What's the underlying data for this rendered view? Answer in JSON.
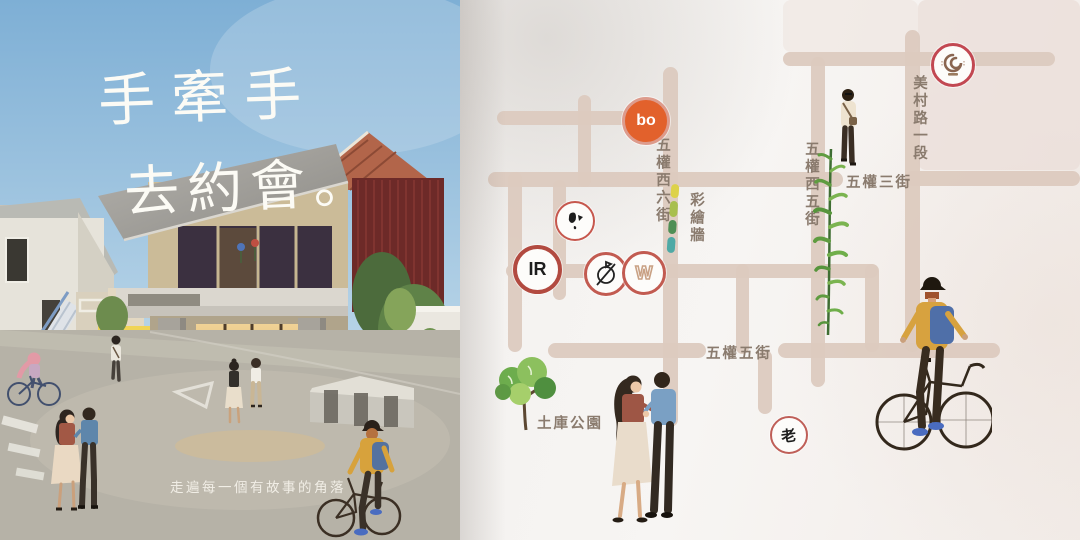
{
  "left_page": {
    "title_line1": "手牽手",
    "title_line2": "去約會。",
    "slogan": "走遍每一個有故事的角落"
  },
  "map_page": {
    "street_labels": {
      "wuquan_west_6th": "五權西六街",
      "painted_wall": "彩繪牆",
      "wuquan_west_5th": "五權西五街",
      "wuquan_3rd": "五權三街",
      "meicun_road_sec_1": "美村路一段",
      "wuquan_5th": "五權五街",
      "tuku_park": "土庫公園"
    },
    "stamps": {
      "bo": "bo",
      "ir": "IR",
      "lao": "老"
    },
    "colors": {
      "street": "#dccabf",
      "street_label": "#8a7b6e",
      "stamp_ring": "#c25b51",
      "bo_badge": "#e2612c",
      "sky": "#7eafd5"
    }
  }
}
